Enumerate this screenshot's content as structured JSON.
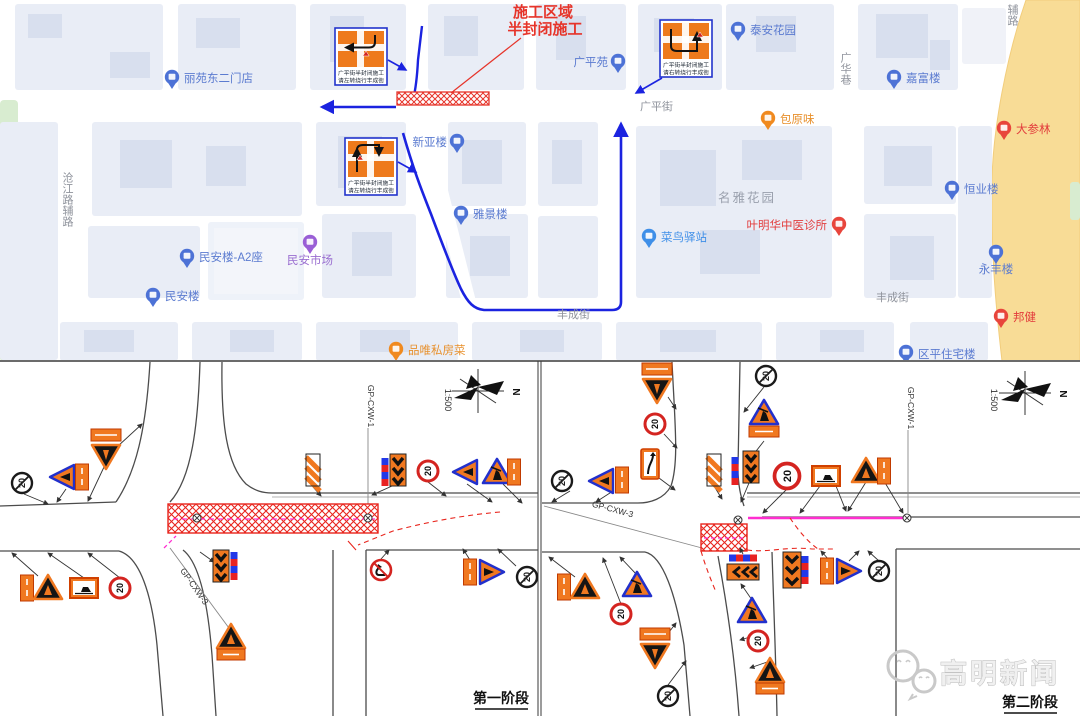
{
  "map": {
    "annotation": {
      "line1": "施工区域",
      "line2": "半封闭施工"
    },
    "detour_boxes": [
      {
        "line1": "广平街半封闭施工",
        "line2": "请左转绕行丰成街"
      },
      {
        "line1": "广平街半封闭施工",
        "line2": "请右转绕行丰成街"
      },
      {
        "line1": "广平街半封闭施工",
        "line2": "请左转绕行丰成街"
      }
    ],
    "pois": [
      {
        "label": "丽苑东二门店",
        "type": "building"
      },
      {
        "label": "广平苑",
        "type": "building"
      },
      {
        "label": "泰安花园",
        "type": "building"
      },
      {
        "label": "嘉富楼",
        "type": "building"
      },
      {
        "label": "包原味",
        "type": "food"
      },
      {
        "label": "大参林",
        "type": "pharmacy"
      },
      {
        "label": "恒业楼",
        "type": "building"
      },
      {
        "label": "新亚楼",
        "type": "building"
      },
      {
        "label": "雅景楼",
        "type": "building"
      },
      {
        "label": "名雅花园",
        "type": "area"
      },
      {
        "label": "菜鸟驿站",
        "type": "logistics"
      },
      {
        "label": "叶明华中医诊所",
        "type": "clinic"
      },
      {
        "label": "民安市场",
        "type": "market"
      },
      {
        "label": "民安楼-A2座",
        "type": "building"
      },
      {
        "label": "民安楼",
        "type": "building"
      },
      {
        "label": "永丰楼",
        "type": "building"
      },
      {
        "label": "邦健",
        "type": "pharmacy"
      },
      {
        "label": "品唯私房菜",
        "type": "restaurant"
      },
      {
        "label": "区平住宅楼",
        "type": "building"
      }
    ],
    "streets": [
      {
        "label": "广平街"
      },
      {
        "label": "丰成街"
      },
      {
        "label": "丰成街"
      },
      {
        "label": "广华巷"
      },
      {
        "label": "沧江路辅路"
      },
      {
        "label": "辅路"
      }
    ],
    "colors": {
      "route": "#1b23e0",
      "closure": "#e6342a",
      "building_label": "#5b7bd0",
      "street_label": "#8f939c",
      "road_yellow": "#f8dc96"
    }
  },
  "diagrams": {
    "speed_limit": "20",
    "scale_label": "1:500",
    "north_label": "N",
    "axis_labels": {
      "main": "GP-CXW-1",
      "cross": "GP-CXW-3"
    },
    "left": {
      "caption": "第一阶段"
    },
    "right": {
      "caption": "第二阶段"
    },
    "sign_legend": [
      "construction-worker-warning",
      "speed-limit-20",
      "end-speed-limit-20",
      "no-left-turn",
      "chevron-alignment-board",
      "striped-delineator-board",
      "warning-light-bar",
      "detour-board",
      "lane-narrows-board"
    ]
  },
  "watermark": {
    "text": "高明新闻"
  }
}
